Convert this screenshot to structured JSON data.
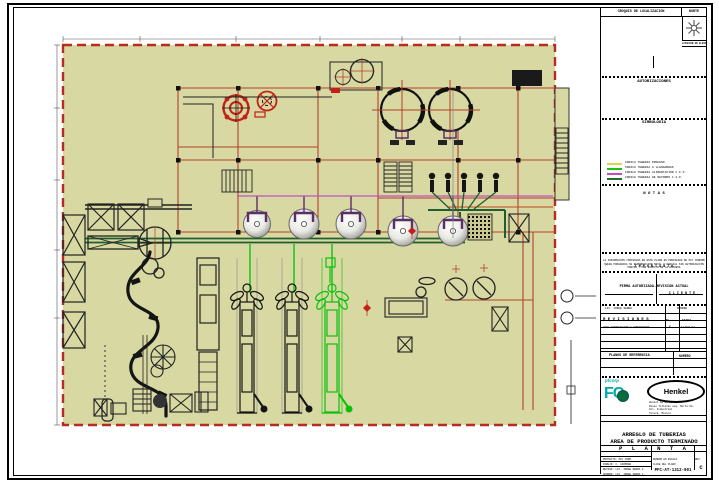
{
  "colors": {
    "drawing_bg": "#d8d8a2",
    "building_border_red": "#b92b1e",
    "grid_red": "#b5402a",
    "pipe_proceso": "#d8d840",
    "pipe_llenadoras": "#19c319",
    "pipe_cip_alimentacion": "#c050c0",
    "pipe_cip_retorno": "#1f6f2f",
    "logo_cyan": "#00a8ac"
  },
  "side_panel": {
    "croquis_label": "CROQUIS DE LOCALIZACION",
    "norte_label": "NORTE",
    "elevacion_label": "LOCALIZACION EN ELEVACION",
    "autorizaciones_title": "AUTORIZACIONES",
    "simbologia_title": "SIMBOLOGIA",
    "valves": [
      {
        "icon": "⊳",
        "label": "INDICA VALVULA CHECK"
      },
      {
        "icon": "⋈",
        "label": "INDICA VALVULA MANUAL"
      },
      {
        "icon": "⋉",
        "label": "INDICA VALVULA NEUMATICA"
      },
      {
        "icon": "⊕",
        "label": "INDICA VALVULA DOBLE SELLO"
      },
      {
        "icon": "◇",
        "label": "INDICA VALVULA DIVERSORA"
      }
    ],
    "pipes": [
      {
        "color": "#d8d840",
        "label": "INDICA TUBERIA PROCESO"
      },
      {
        "color": "#19c319",
        "label": "INDICA TUBERIA A LLENADORAS"
      },
      {
        "color": "#c050c0",
        "label": "INDICA TUBERIA ALIMENTACION C.I.P."
      },
      {
        "color": "#1f6f2f",
        "label": "INDICA TUBERIA DE RETORNO C.I.P."
      }
    ],
    "notas_title": "N O T A S",
    "importante_title": "I M P O R T A N T E",
    "importante_lines": [
      "LA INFORMACION CONTENIDA EN ESTE PLANO ES PROPIEDAD DE PFC CORPORATIVO",
      "QUEDA PROHIBIDA SU REPRODUCCION TOTAL O PARCIAL SIN AUTORIZACION",
      "PREVIA Y POR ESCRITO DE LA EMPRESA"
    ],
    "firma_header": "FIRMA AUTORIZADA-REVISION ACTUAL",
    "cliente_label": "C L I E N T E",
    "firma_nombre_left": "LIC. JORGE SERRA",
    "nombre_label": "NOMBRE",
    "revisiones_title": "R E V I S I O N E S",
    "rev_no_label": "No.",
    "rev_fecha_label": "FECHA",
    "rev_row": {
      "desc": "PARA AUTORIZACION Y COMENTARIOS",
      "no": "C",
      "fecha": "17/DIC/12"
    },
    "planos_title": "PLANOS DE REFERENCIA",
    "planos_numero_label": "NUMERO",
    "pfcorp_small": "pfcorp",
    "pfcorp_big": "FC",
    "henkel_label": "Henkel",
    "henkel_address": [
      "Henkel SA de C.V.",
      "Paseo Tollocan esq. Norte Km.",
      "Col. Industrial",
      "Toluca, Mexico"
    ],
    "titulo_header": "TITULO DEL PLANO",
    "titulo_line1": "ARREGLO DE TUBERIAS",
    "titulo_line2": "AREA DE PRODUCTO TERMINADO",
    "titulo_line3": "P L A N T A",
    "info_rows": [
      "PROYECTO: PFC CORP.",
      "DIBUJO: C. CARMONA",
      "REVISO: LIC. JORGE SERRA F.",
      "APROBO: LIC. JORGE SERRA F.",
      "FECHA: DICIEMBRE 2012"
    ],
    "escala_label": "NUMERO EN ESCALA",
    "rev_label": "REV.",
    "clave_label": "CLAVE DEL PLANO",
    "clave_value": "PFC-AT-1312-001",
    "rev_value": "C"
  }
}
